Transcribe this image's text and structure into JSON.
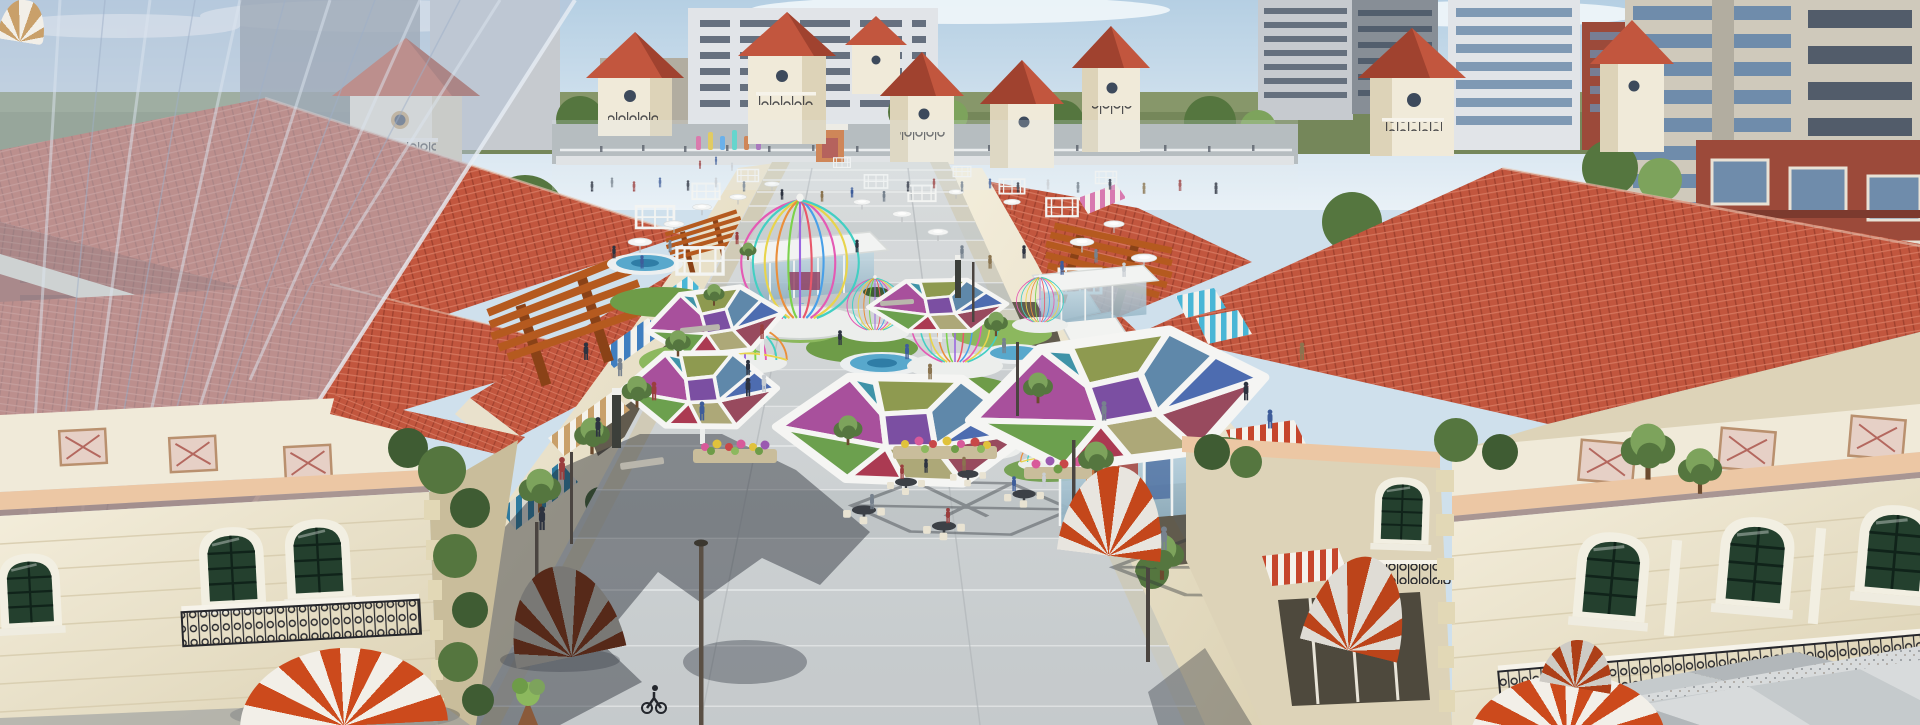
{
  "scene": {
    "title": "Aerial 3D architectural rendering of a Mediterranean-style open-air shopping street with a crowded central plaza",
    "time_of_day": "daytime, sunny with light clouds",
    "style": "photorealistic architectural visualization, no text or watermark visible",
    "landmarks": [
      "red clay-tile hip roofs with cream bell towers",
      "central pedestrian plaza receding to a cross street",
      "multicolored geometric stained-glass canopies on white frames",
      "birdcage-shaped pavilions with rainbow ribs on round platforms",
      "red-and-white striped dome awnings on corner buildings",
      "blue, cyan, pink and tan striped shop awnings",
      "rust-colored corten steel pergolas",
      "white umbrellas and white pergola frames with crowds",
      "glass cafe kiosks with outdoor tables and flower planters",
      "translucent glass curtain-wall tower at far left",
      "modern apartment high-rises and brick buildings in background",
      "green street trees, lawns and circular pools"
    ]
  },
  "palette": {
    "sky": {
      "top": "#b5cfe3",
      "bottom": "#e9f1f7",
      "cloud": "#f8fbfd"
    },
    "horizon": {
      "green": "#75875a",
      "green_light": "#93a274"
    },
    "bg": {
      "road": "#aab0b3",
      "apt_gray": "#c6cacf",
      "apt_dark": "#878e96",
      "apt_white": "#e1e4e8",
      "concrete": "#cfc9bb",
      "concrete_dark": "#b2ada0",
      "brick": "#9c4a3a",
      "brick_dark": "#7c3a2e",
      "glass_tower": "#b7c3d6",
      "window_glass": "#6f8cab",
      "window_dark": "#3d4a5c"
    },
    "med": {
      "roof_red": "#c2563e",
      "roof_red_light": "#d5765e",
      "roof_red_dark": "#a0422f",
      "eave_cream": "#e9e1cc",
      "wall_cream": "#f0ead9",
      "wall_cream_shade": "#ddd3b8",
      "stone_tan": "#e2d8b6",
      "stone_shade": "#c9bd9b",
      "trim_peach": "#ecc7a4",
      "tile_panel": "#e6d0c6",
      "tile_panel_line": "#b4685f",
      "window_green": "#24402e",
      "window_grid": "#10231a",
      "iron_black": "#26272c"
    },
    "street": {
      "pergola_rust": "#b55a1f",
      "pergola_dark": "#8a4217",
      "awning_blue": "#3f7ec0",
      "awning_cyan": "#49b6d6",
      "awning_red": "#c6462c",
      "awning_pink": "#d87ab0",
      "awning_tan": "#c9a06a",
      "awning_teal": "#2e7a9e",
      "awning_white": "#f4f2ec",
      "sign_magenta": "#c2489a"
    },
    "plaza": {
      "paving_light": "#d8dbdc",
      "paving_mid": "#c5cacc",
      "paving_band": "#b2b7ba",
      "paving_dark": "#8f959a",
      "walk_beige": "#cfc8ae",
      "granite": "#b9bdc0",
      "joint": "#e9ebec",
      "shadow": "rgba(28,33,43,0.42)"
    },
    "features": {
      "lawn": "#6e9c48",
      "lawn_light": "#8cb85e",
      "pool": "#58a8cc",
      "pool_dark": "#2f7da6",
      "platform": "#eceeec",
      "canopy_frame": "#f5f5f3",
      "glass": "#a8c4d2",
      "kiosk_orange": "#c96a2e",
      "kiosk_red": "#a83c34",
      "kiosk_blue": "#46689e",
      "flower_pink": "#d85a9a",
      "flower_red": "#c84848",
      "flower_yellow": "#e0c23c",
      "flower_purple": "#9a5ab0",
      "table_dark": "#3c4046",
      "chair_cream": "#e9e3d2",
      "tree": "#55763f",
      "tree_light": "#7da35c",
      "tree_dark": "#3f5c33",
      "totem_dark": "#3c3f3a",
      "lamp_dark": "#4a4440"
    },
    "canopy": {
      "magenta": "#a8509c",
      "olive": "#8e9a50",
      "steel": "#5f88aa",
      "maroon": "#984a5e",
      "khaki": "#ada878",
      "green": "#6ca04e",
      "teal": "#3f93a8",
      "blue": "#4d6cb0",
      "crimson": "#ab3a52",
      "purple": "#7b4fa2",
      "pink": "#c473a8"
    },
    "cage": {
      "pink": "#e45ab4",
      "teal": "#43cfc3",
      "yellow": "#e8d44c",
      "orange": "#ea8f3c",
      "green": "#7cd24c",
      "violet": "#9a66e0",
      "red": "#e8586a",
      "blue": "#49a0e8"
    },
    "dome": {
      "orange": "#cc4a1c",
      "white": "#f2efe8",
      "tan": "#c9a06a"
    },
    "people": {
      "dark": "#2d3340",
      "gray": "#77828e",
      "light": "#c9ced3",
      "red": "#9a3e3e",
      "blue": "#3e5d9a",
      "tan": "#8a744f",
      "green": "#2f5d46"
    }
  }
}
